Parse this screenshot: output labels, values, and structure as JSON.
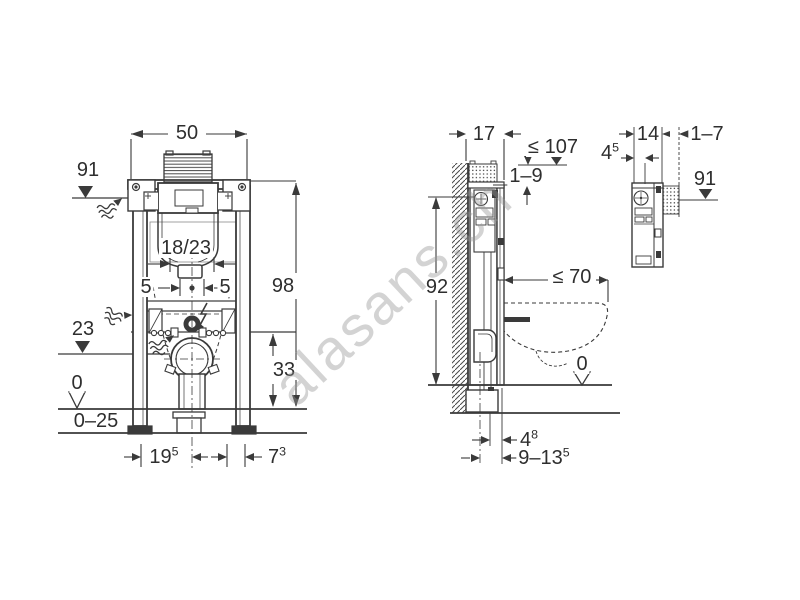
{
  "colors": {
    "line": "#3a3a3a",
    "text": "#2e2e2e",
    "watermark_text": "#969696"
  },
  "watermark": {
    "text": "alasans.ch"
  },
  "views": {
    "front": {
      "labels": {
        "width": "50",
        "top_level": "91",
        "service_opening": "18/23",
        "bolt_left": "5",
        "bolt_right": "5",
        "outlet_level": "23",
        "frame_height": "98",
        "drain_height": "33",
        "floor_level": "0",
        "floor_buildup": "0–25",
        "foot_offset": {
          "main": "19",
          "sup": "5"
        },
        "side_offset": {
          "main": "7",
          "sup": "3"
        }
      }
    },
    "side": {
      "labels": {
        "frame_depth": "17",
        "max_top": "≤ 107",
        "top_adjust": "1–9",
        "fixing_height": "92",
        "pan_depth": "≤ 70",
        "floor_level": "0",
        "outlet_offset": {
          "main": "4",
          "sup": "8"
        },
        "outlet_range": {
          "main": "9–13",
          "sup": "5"
        }
      }
    },
    "detail": {
      "labels": {
        "unit_depth": "14",
        "finish_range": "1–7",
        "plate_offset": {
          "main": "4",
          "sup": "5"
        },
        "plate_level": "91"
      }
    }
  }
}
